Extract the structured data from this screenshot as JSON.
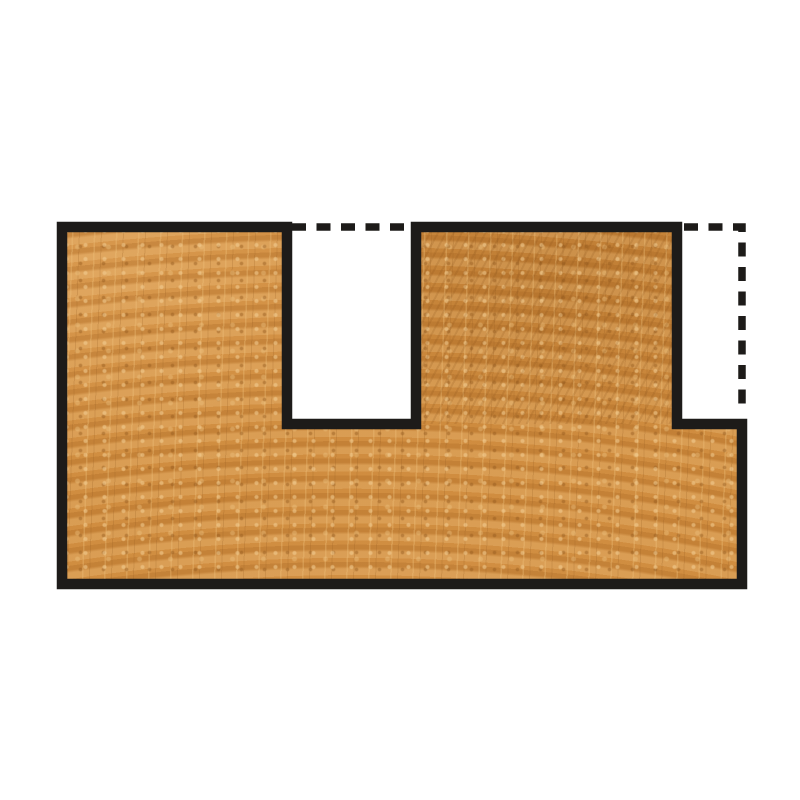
{
  "figure": {
    "name": "dado-and-rabbet-cut-profile",
    "kind": "woodworking cross-section illustration",
    "elements": {
      "wood_block": "end-grain wood board cross-section",
      "dado_cut": "square groove cut down through the top face",
      "rabbet_cut": "notch cut out of the top-right corner",
      "dashed_outline": "dashed lines marking the removed material at the original surface"
    }
  },
  "colors": {
    "background": "#ffffff",
    "outline": "#1d1b19",
    "wood_base": "#cf8b3d",
    "wood_light": "#e7b269",
    "wood_dark": "#a96a24",
    "cutout_fill": "#ffffff",
    "shadow": "rgba(0,0,0,0.28)"
  }
}
